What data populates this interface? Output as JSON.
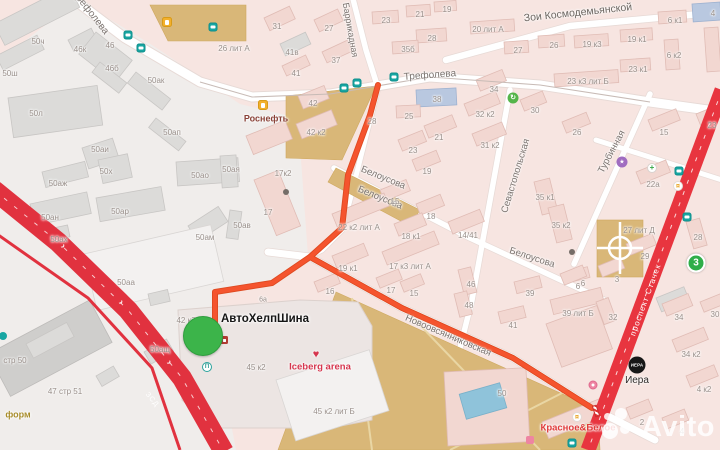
{
  "map": {
    "watermark": "Avito",
    "marker": {
      "label": "АвтоХелпШина",
      "x": 203,
      "y": 336,
      "r": 19,
      "color": "#3cb44a"
    },
    "route": {
      "color": "#f5542e",
      "casing": "#de4a21",
      "main": "378,85 370,115 348,175 342,228 310,257 272,283 215,292 215,330",
      "branch": "310,257 402,308 513,358 592,408"
    },
    "badge3": {
      "t": "3",
      "x": 696,
      "y": 263
    },
    "iera": {
      "t": "ИЕРА",
      "x": 637,
      "y": 365
    },
    "street_labels": [
      {
        "t": "Трефолева",
        "x": 90,
        "y": 13,
        "r": 52,
        "fs": 10,
        "c": "#7b736f"
      },
      {
        "t": "Трефолева",
        "x": 430,
        "y": 76,
        "r": -4,
        "fs": 10,
        "c": "#7b736f"
      },
      {
        "t": "Баррикадная",
        "x": 350,
        "y": 30,
        "r": 80,
        "fs": 9,
        "c": "#7b736f"
      },
      {
        "t": "Зои Космодемьянской",
        "x": 578,
        "y": 13,
        "r": -6,
        "fs": 10.5,
        "c": "#6b6560"
      },
      {
        "t": "Севастопольская",
        "x": 516,
        "y": 176,
        "r": -73,
        "fs": 9.5,
        "c": "#7b736f"
      },
      {
        "t": "Белоусова",
        "x": 383,
        "y": 178,
        "r": 22,
        "fs": 9.5,
        "c": "#7b736f"
      },
      {
        "t": "Белоусова",
        "x": 380,
        "y": 198,
        "r": 22,
        "fs": 9.5,
        "c": "#7b736f"
      },
      {
        "t": "Белоусова",
        "x": 532,
        "y": 258,
        "r": 18,
        "fs": 9.5,
        "c": "#7b736f"
      },
      {
        "t": "Турбинная",
        "x": 612,
        "y": 152,
        "r": -62,
        "fs": 9.5,
        "c": "#7b736f"
      },
      {
        "t": "Новоовсянниковская",
        "x": 448,
        "y": 336,
        "r": 23,
        "fs": 9.5,
        "c": "#7b736f"
      },
      {
        "t": "проспект Стачек",
        "x": 646,
        "y": 300,
        "r": -70,
        "fs": 8,
        "c": "#ffffff"
      },
      {
        "t": "ЗСД",
        "x": 152,
        "y": 400,
        "r": 50,
        "fs": 7,
        "c": "#ffffff"
      }
    ],
    "building_labels": [
      {
        "t": "50ч",
        "x": 38,
        "y": 42
      },
      {
        "t": "46к",
        "x": 80,
        "y": 50
      },
      {
        "t": "46",
        "x": 110,
        "y": 46
      },
      {
        "t": "46б",
        "x": 112,
        "y": 69
      },
      {
        "t": "50ак",
        "x": 156,
        "y": 81
      },
      {
        "t": "50ш",
        "x": 10,
        "y": 74
      },
      {
        "t": "50л",
        "x": 36,
        "y": 114
      },
      {
        "t": "26 лит А",
        "x": 234,
        "y": 49
      },
      {
        "t": "50ап",
        "x": 172,
        "y": 133
      },
      {
        "t": "50аи",
        "x": 100,
        "y": 150
      },
      {
        "t": "50х",
        "x": 106,
        "y": 172
      },
      {
        "t": "50аж",
        "x": 58,
        "y": 184
      },
      {
        "t": "50ао",
        "x": 200,
        "y": 176
      },
      {
        "t": "50ая",
        "x": 231,
        "y": 170
      },
      {
        "t": "50ан",
        "x": 50,
        "y": 218
      },
      {
        "t": "50ар",
        "x": 120,
        "y": 212
      },
      {
        "t": "50ах",
        "x": 59,
        "y": 240
      },
      {
        "t": "50ав",
        "x": 242,
        "y": 226
      },
      {
        "t": "50ам",
        "x": 205,
        "y": 238
      },
      {
        "t": "50аа",
        "x": 126,
        "y": 283
      },
      {
        "t": "стр 50",
        "x": 15,
        "y": 361
      },
      {
        "t": "47 стр 51",
        "x": 65,
        "y": 392
      },
      {
        "t": "50ащ",
        "x": 160,
        "y": 350
      },
      {
        "t": "42 к3",
        "x": 186,
        "y": 321
      },
      {
        "t": "6а",
        "x": 263,
        "y": 300,
        "fs": 7
      },
      {
        "t": "50",
        "x": 502,
        "y": 394
      },
      {
        "t": "31",
        "x": 277,
        "y": 27
      },
      {
        "t": "27",
        "x": 329,
        "y": 29
      },
      {
        "t": "23",
        "x": 386,
        "y": 21
      },
      {
        "t": "21",
        "x": 420,
        "y": 15
      },
      {
        "t": "19",
        "x": 447,
        "y": 10
      },
      {
        "t": "41в",
        "x": 292,
        "y": 53
      },
      {
        "t": "41",
        "x": 296,
        "y": 74
      },
      {
        "t": "37",
        "x": 336,
        "y": 61
      },
      {
        "t": "42",
        "x": 313,
        "y": 104
      },
      {
        "t": "42 к2",
        "x": 316,
        "y": 133
      },
      {
        "t": "28",
        "x": 432,
        "y": 39
      },
      {
        "t": "35б",
        "x": 408,
        "y": 50
      },
      {
        "t": "17к2",
        "x": 283,
        "y": 174
      },
      {
        "t": "17",
        "x": 268,
        "y": 213
      },
      {
        "t": "28",
        "x": 372,
        "y": 122
      },
      {
        "t": "38",
        "x": 437,
        "y": 100
      },
      {
        "t": "25",
        "x": 409,
        "y": 117
      },
      {
        "t": "34",
        "x": 494,
        "y": 90
      },
      {
        "t": "32 к2",
        "x": 485,
        "y": 115
      },
      {
        "t": "30",
        "x": 535,
        "y": 111
      },
      {
        "t": "21",
        "x": 439,
        "y": 138
      },
      {
        "t": "23",
        "x": 413,
        "y": 151
      },
      {
        "t": "31 к2",
        "x": 490,
        "y": 146
      },
      {
        "t": "19",
        "x": 427,
        "y": 172
      },
      {
        "t": "26",
        "x": 554,
        "y": 46
      },
      {
        "t": "26",
        "x": 577,
        "y": 133
      },
      {
        "t": "15",
        "x": 395,
        "y": 202
      },
      {
        "t": "18",
        "x": 431,
        "y": 217
      },
      {
        "t": "18 к1",
        "x": 411,
        "y": 237
      },
      {
        "t": "14/41",
        "x": 468,
        "y": 236
      },
      {
        "t": "22 к2 лит А",
        "x": 359,
        "y": 228
      },
      {
        "t": "17 к3 лит А",
        "x": 410,
        "y": 267
      },
      {
        "t": "35 к1",
        "x": 545,
        "y": 198
      },
      {
        "t": "35 к2",
        "x": 561,
        "y": 226
      },
      {
        "t": "19 к1",
        "x": 348,
        "y": 269
      },
      {
        "t": "16",
        "x": 330,
        "y": 292
      },
      {
        "t": "17",
        "x": 391,
        "y": 291
      },
      {
        "t": "15",
        "x": 414,
        "y": 294
      },
      {
        "t": "46",
        "x": 471,
        "y": 285
      },
      {
        "t": "48",
        "x": 469,
        "y": 306
      },
      {
        "t": "39",
        "x": 530,
        "y": 294
      },
      {
        "t": "41",
        "x": 513,
        "y": 326
      },
      {
        "t": "6",
        "x": 583,
        "y": 284
      },
      {
        "t": "39 лит Б",
        "x": 578,
        "y": 314
      },
      {
        "t": "19 к3",
        "x": 592,
        "y": 45
      },
      {
        "t": "19 к1",
        "x": 637,
        "y": 40
      },
      {
        "t": "6 к1",
        "x": 675,
        "y": 21
      },
      {
        "t": "6 к2",
        "x": 674,
        "y": 56
      },
      {
        "t": "23 к1",
        "x": 638,
        "y": 70
      },
      {
        "t": "23 к3 лит Б",
        "x": 588,
        "y": 82
      },
      {
        "t": "4",
        "x": 713,
        "y": 14
      },
      {
        "t": "20 лит А",
        "x": 488,
        "y": 30
      },
      {
        "t": "27",
        "x": 518,
        "y": 51
      },
      {
        "t": "15",
        "x": 664,
        "y": 133
      },
      {
        "t": "23",
        "x": 712,
        "y": 126
      },
      {
        "t": "22а",
        "x": 653,
        "y": 185
      },
      {
        "t": "27 лит Д",
        "x": 639,
        "y": 231
      },
      {
        "t": "29",
        "x": 645,
        "y": 257
      },
      {
        "t": "3",
        "x": 617,
        "y": 280
      },
      {
        "t": "6",
        "x": 578,
        "y": 287
      },
      {
        "t": "28",
        "x": 698,
        "y": 238
      },
      {
        "t": "32",
        "x": 613,
        "y": 318
      },
      {
        "t": "34",
        "x": 679,
        "y": 318
      },
      {
        "t": "34 к2",
        "x": 691,
        "y": 355
      },
      {
        "t": "4 к2",
        "x": 704,
        "y": 390
      },
      {
        "t": "2",
        "x": 642,
        "y": 423
      },
      {
        "t": "4",
        "x": 682,
        "y": 432
      },
      {
        "t": "30",
        "x": 715,
        "y": 315
      },
      {
        "t": "45 к2",
        "x": 256,
        "y": 368
      },
      {
        "t": "45 к2 лит Б",
        "x": 334,
        "y": 412
      }
    ],
    "poi_labels": [
      {
        "t": "Роснефть",
        "x": 266,
        "y": 119,
        "c": "#8a4238",
        "fs": 9,
        "b": 1
      },
      {
        "t": "Iceberg arena",
        "x": 320,
        "y": 367,
        "c": "#d6364e",
        "fs": 9.5,
        "b": 1
      },
      {
        "t": "Красное&Белое",
        "x": 578,
        "y": 428,
        "c": "#e03a3a",
        "fs": 9.5,
        "b": 1
      },
      {
        "t": "Иера",
        "x": 637,
        "y": 381,
        "c": "#2e2a28",
        "fs": 10,
        "b": 0
      },
      {
        "t": "форм",
        "x": 18,
        "y": 415,
        "c": "#a88d2c",
        "fs": 9,
        "b": 1
      }
    ],
    "pois": [
      {
        "n": "transit-stop-icon",
        "t": "stop",
        "x": 128,
        "y": 35
      },
      {
        "n": "transit-stop-icon",
        "t": "stop",
        "x": 141,
        "y": 48
      },
      {
        "n": "transit-stop-icon",
        "t": "stop",
        "x": 344,
        "y": 88
      },
      {
        "n": "transit-stop-icon",
        "t": "stop",
        "x": 357,
        "y": 83
      },
      {
        "n": "transit-stop-icon",
        "t": "stop",
        "x": 394,
        "y": 77
      },
      {
        "n": "transit-stop-icon",
        "t": "stop",
        "x": 679,
        "y": 171
      },
      {
        "n": "transit-stop-icon",
        "t": "stop",
        "x": 687,
        "y": 217
      },
      {
        "n": "transit-stop-icon",
        "t": "stop",
        "x": 572,
        "y": 443
      },
      {
        "n": "transit-stop-icon",
        "t": "stop",
        "x": 213,
        "y": 27
      },
      {
        "n": "transit-dot-icon",
        "t": "dotteal",
        "x": 3,
        "y": 336
      },
      {
        "n": "fuel-station-icon",
        "t": "fuel",
        "x": 263,
        "y": 105
      },
      {
        "n": "fuel-station-icon",
        "t": "fuel",
        "x": 167,
        "y": 22
      },
      {
        "n": "recycling-icon",
        "t": "recycle",
        "x": 513,
        "y": 98
      },
      {
        "n": "culture-icon",
        "t": "culture",
        "x": 622,
        "y": 162
      },
      {
        "n": "pharmacy-icon",
        "t": "pharmacy",
        "x": 652,
        "y": 168
      },
      {
        "n": "store-cart-icon",
        "t": "cart",
        "x": 678,
        "y": 186
      },
      {
        "n": "store-cart-icon",
        "t": "cart",
        "x": 577,
        "y": 417
      },
      {
        "n": "shop-icon",
        "t": "shop",
        "x": 593,
        "y": 385
      },
      {
        "n": "parking-icon",
        "t": "parking",
        "x": 207,
        "y": 367
      },
      {
        "n": "poi-dot",
        "t": "dot",
        "x": 286,
        "y": 192
      },
      {
        "n": "poi-dot",
        "t": "dot",
        "x": 572,
        "y": 252
      },
      {
        "n": "shop-square-icon",
        "t": "pinksq",
        "x": 530,
        "y": 440
      },
      {
        "n": "barrier-icon",
        "t": "barrier",
        "x": 596,
        "y": 411
      },
      {
        "n": "heart-icon",
        "t": "heart",
        "x": 316,
        "y": 355
      },
      {
        "n": "storefront-icon",
        "t": "storefront",
        "x": 224,
        "y": 340
      }
    ]
  }
}
